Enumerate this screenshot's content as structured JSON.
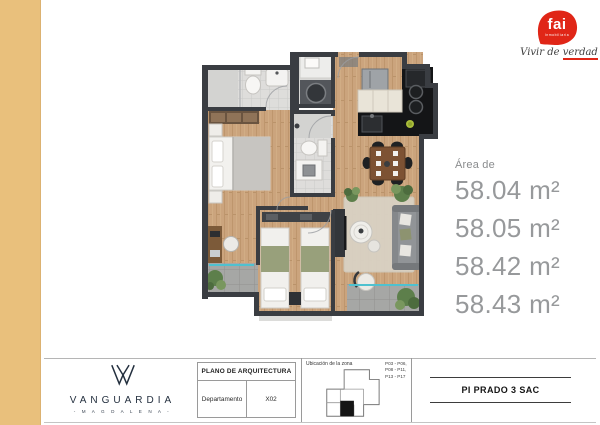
{
  "branding": {
    "fai": {
      "logo_text": "fai",
      "logo_subtext": "Inmobiliaria",
      "tagline_prefix": "Vivir de ",
      "tagline_underlined": "verdad",
      "red": "#e02617"
    },
    "vanguardia": {
      "title": "VANGUARDIA",
      "subtitle": "- M A G D A L E N A -",
      "navy": "#24303f"
    }
  },
  "area_panel": {
    "label": "Área de",
    "values": [
      "58.04 m²",
      "58.05 m²",
      "58.42 m²",
      "58.43 m²"
    ],
    "text_color": "#97999b"
  },
  "floorplan": {
    "colors": {
      "wall": "#3a3d42",
      "wood_floor": "#cba47d",
      "bath_tile": "#dedddb",
      "balcony_tile": "#a6a7a5",
      "kitchen_counter": "#141517",
      "glass": "#4fc1cf",
      "plant_green": "#5d7f4b",
      "side_stripe": "#e9c07c"
    }
  },
  "footer": {
    "plan_table": {
      "header": "PLANO DE ARQUITECTURA",
      "row_label": "Departamento",
      "row_value": "X02"
    },
    "zone": {
      "label": "Ubicación de la zona",
      "units_lines": [
        "P03 - P06,",
        "P08 - P11,",
        "P13 - P17"
      ]
    },
    "developer": "PI PRADO 3 SAC"
  }
}
